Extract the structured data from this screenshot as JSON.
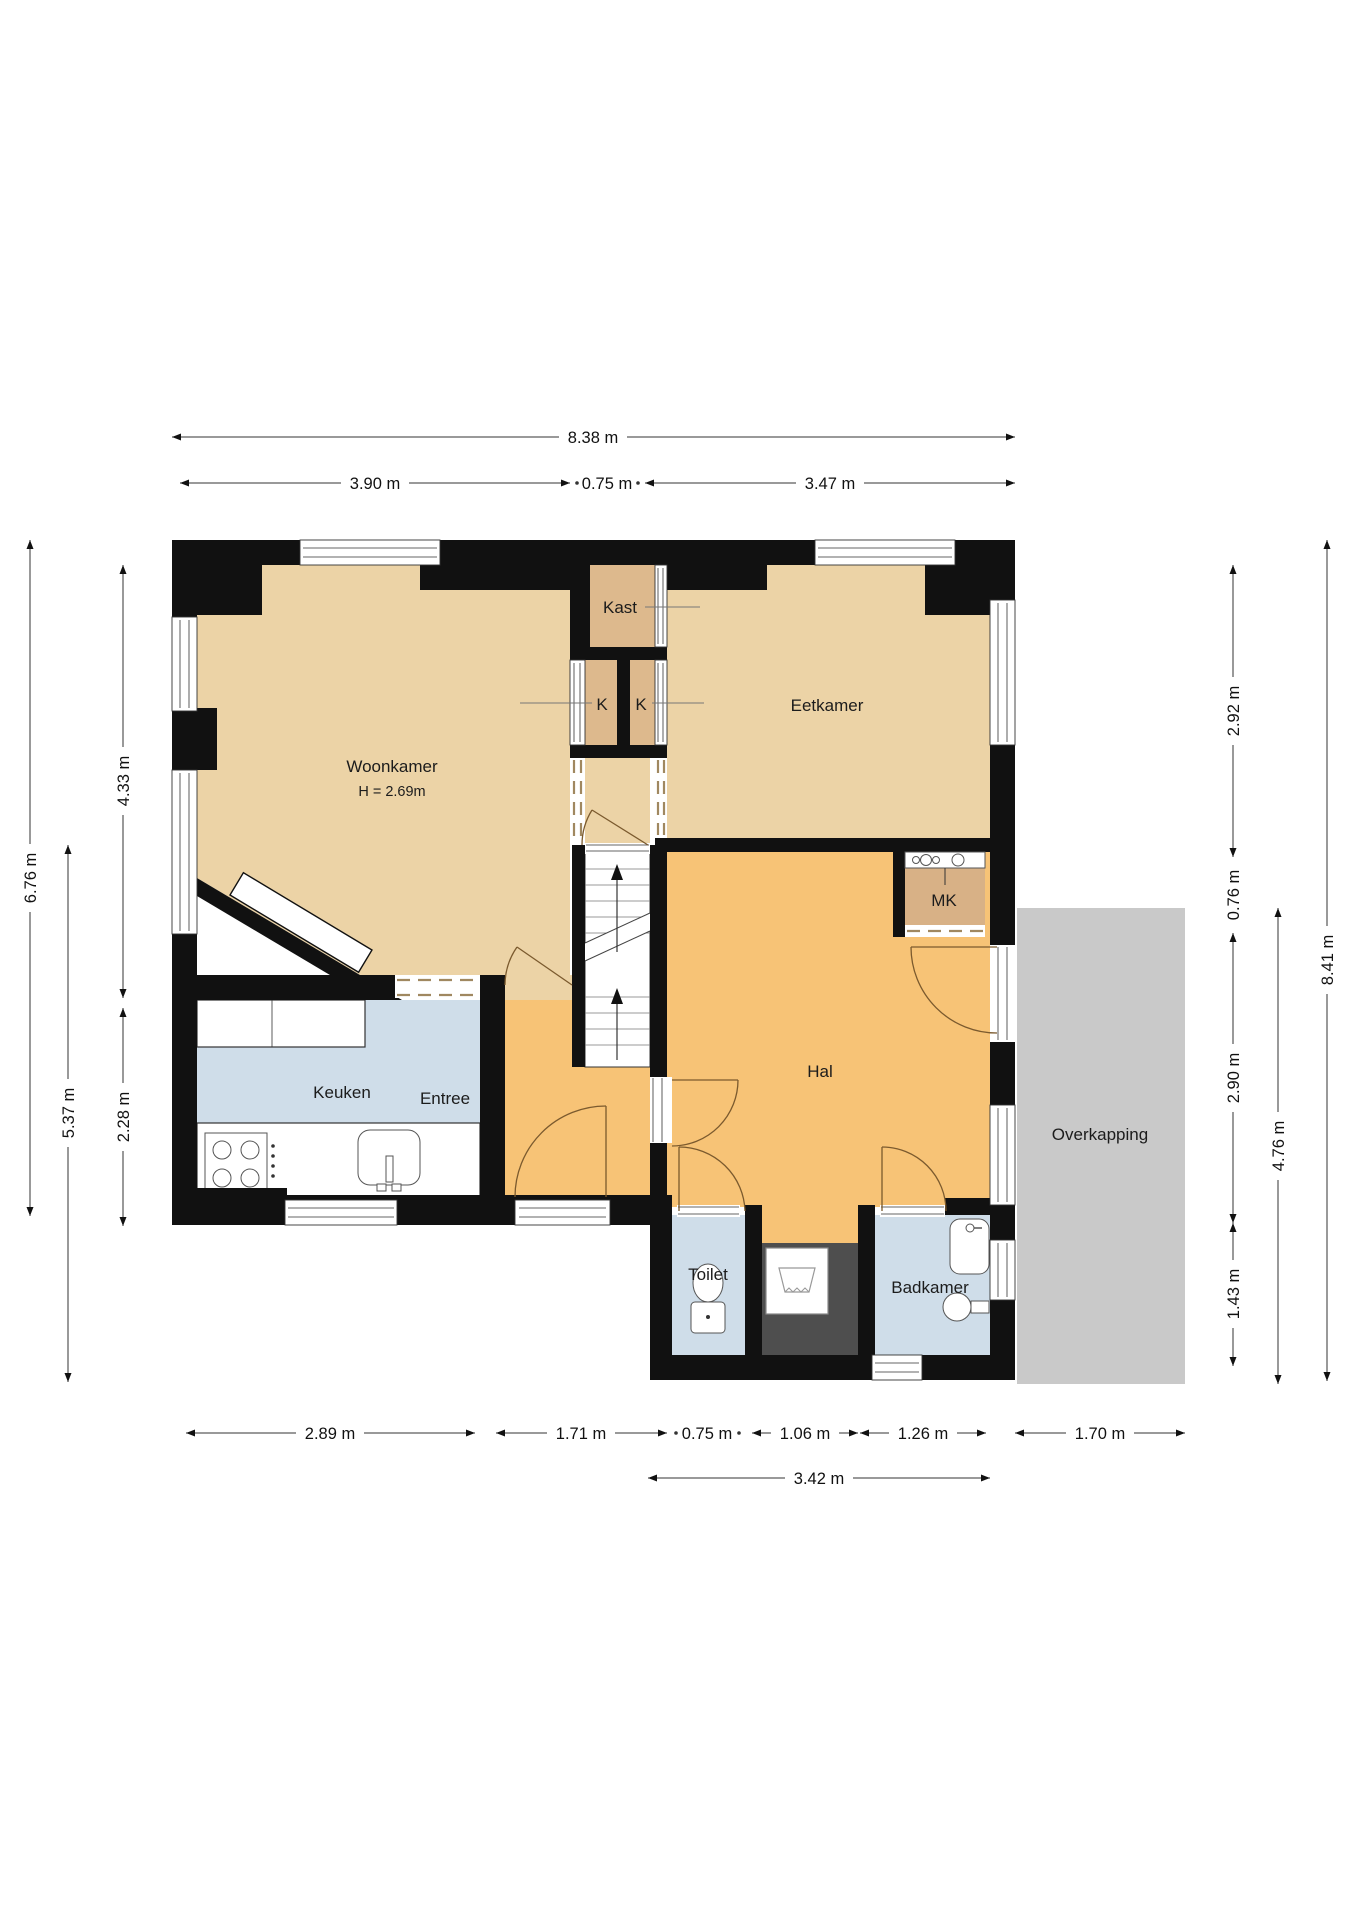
{
  "title": "Floor plan begane grond",
  "rooms": {
    "woonkamer": {
      "label": "Woonkamer",
      "height_note": "H = 2.69m"
    },
    "eetkamer": {
      "label": "Eetkamer"
    },
    "kast": {
      "label": "Kast"
    },
    "k_left": {
      "label": "K"
    },
    "k_right": {
      "label": "K"
    },
    "keuken": {
      "label": "Keuken"
    },
    "entree": {
      "label": "Entree"
    },
    "hal": {
      "label": "Hal"
    },
    "mk": {
      "label": "MK"
    },
    "toilet": {
      "label": "Toilet"
    },
    "badkamer": {
      "label": "Badkamer"
    },
    "overkapping": {
      "label": "Overkapping"
    }
  },
  "dims": {
    "top": [
      "8.38 m",
      "3.90 m",
      "0.75 m",
      "3.47 m"
    ],
    "left": [
      "6.76 m",
      "5.37 m",
      "4.33 m",
      "2.28 m"
    ],
    "right": [
      "2.92 m",
      "0.76 m",
      "2.90 m",
      "1.43 m",
      "4.76 m",
      "8.41 m"
    ],
    "bottom": [
      "2.89 m",
      "1.71 m",
      "0.75 m",
      "1.06 m",
      "1.26 m",
      "1.70 m",
      "3.42 m"
    ]
  },
  "colors": {
    "wall": "#111111",
    "room_tan": "#ecd3a6",
    "closet_tan": "#ddb98d",
    "mk_tan": "#d8b186",
    "hall_orange": "#f7c376",
    "wet_blue": "#cfdde9",
    "canopy_gray": "#c9c9c9",
    "niche_dark": "#4e4e4e",
    "door_arc": "#7b5a2e"
  }
}
